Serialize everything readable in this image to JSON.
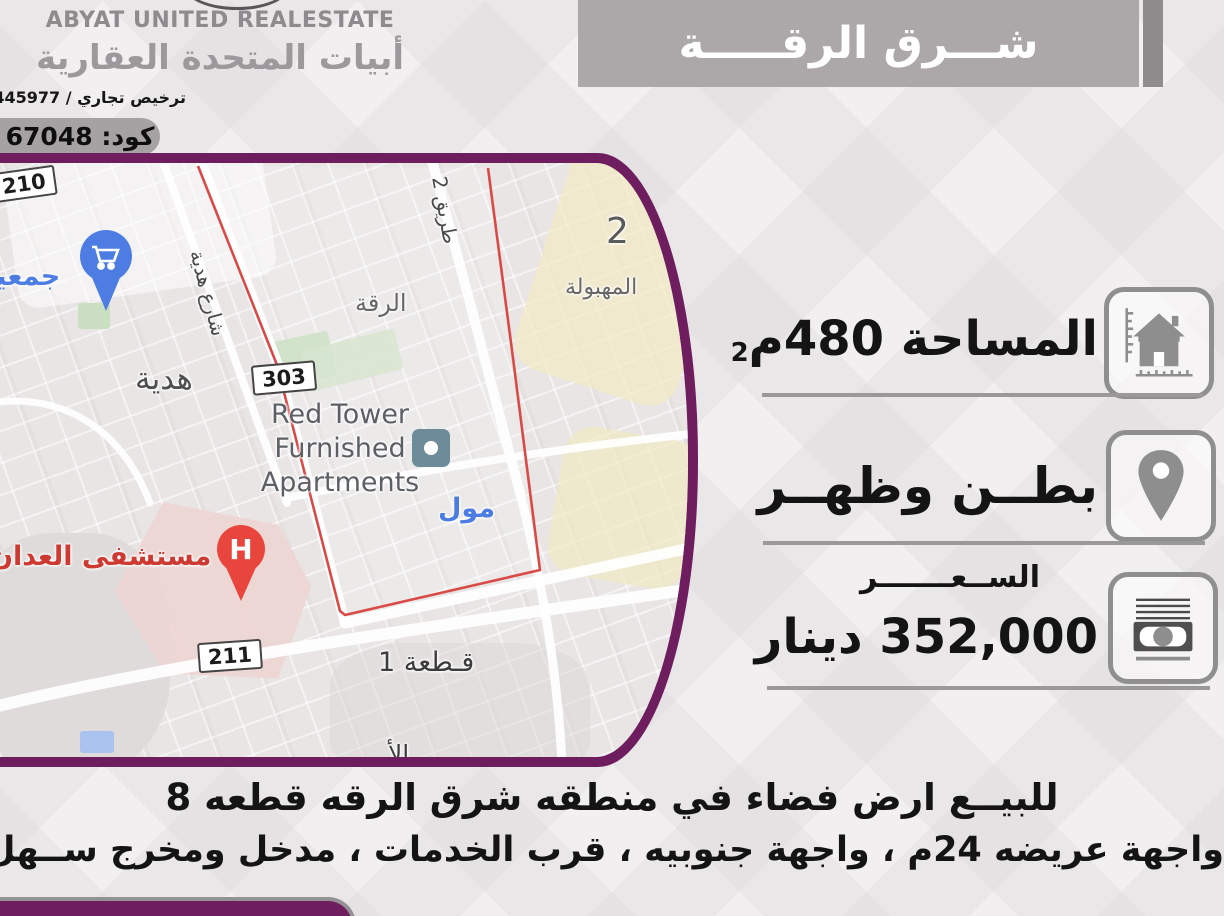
{
  "header": {
    "company_en": "ABYAT UNITED REALESTATE",
    "company_ar": "أبيات المتحدة العقارية",
    "license": "ترخيص تجاري / 445977",
    "code": "كود: 67048",
    "banner_title": "شـــرق الرقـــــة"
  },
  "details": {
    "area_label": "المساحة 480م",
    "area_sup": "2",
    "location_value": "بطــن وظهــر",
    "price_label": "الســعـــــــر",
    "price_value": "352,000 دينار"
  },
  "description": {
    "line1": "للبيــع ارض فضاء في منطقه شرق الرقه قطعه 8",
    "line2": "واجهة عريضه 24م ، واجهة جنوبيه ، قرب الخدمات ، مدخل ومخرج ســهل."
  },
  "map": {
    "badge_210": "210",
    "badge_303": "303",
    "badge_211": "211",
    "coop_label": "جمعية",
    "hadiya_street": "شارع هدية",
    "hadiya": "هدية",
    "riqqa": "الرقة",
    "road_2": "طريق 2",
    "block_2": "2",
    "mahboula": "المهبولة",
    "red_tower_line1": "Red Tower",
    "red_tower_line2": "Furnished",
    "red_tower_line3": "Apartments",
    "hospital_label": "مستشفى العدان",
    "mall_label": "مول",
    "block_1": "قـطعة 1",
    "partial_label": "الأ"
  },
  "colors": {
    "accent_purple": "#6e1d5f",
    "banner_gray": "#aca8a9",
    "map_red_line": "#d94a47",
    "google_blue": "#4d7de2",
    "hospital_red": "#cd3a31"
  }
}
